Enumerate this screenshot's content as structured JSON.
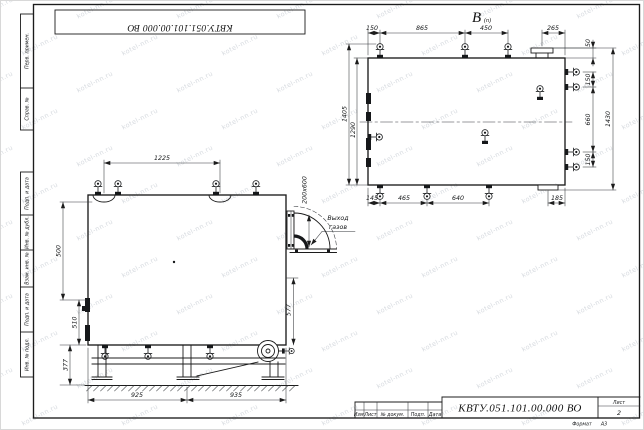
{
  "stamp": {
    "doc_number_rotated": "КВТУ.051.101.00.000  ВО"
  },
  "view_label": {
    "main": "В",
    "sub": "(п)"
  },
  "front_view": {
    "dim_top": "1225",
    "dim_left_upper": "500",
    "dim_left_mid": "510",
    "dim_left_lower": "377",
    "dim_right": "577",
    "dim_duct": "200x600",
    "dim_bottom_left": "925",
    "dim_bottom_right": "935",
    "label_gas_outlet_line1": "Выход",
    "label_gas_outlet_line2": "газов"
  },
  "plan_view": {
    "dim_top_1": "150",
    "dim_top_2": "865",
    "dim_top_3": "450",
    "dim_top_4": "265",
    "dim_flange_offset": "50",
    "dim_right_1": "150",
    "dim_right_2": "660",
    "dim_right_3": "150",
    "dim_right_overall": "1430",
    "dim_left_outer": "1405",
    "dim_left_inner": "1290",
    "dim_bottom_1": "145",
    "dim_bottom_2": "465",
    "dim_bottom_3": "640",
    "dim_bottom_4": "185"
  },
  "margin_labels": {
    "cell_1": "Перв. примен.",
    "cell_2": "Справ. №",
    "cell_3": "Подп. и дата",
    "cell_4": "Инв. № дубл.",
    "cell_5": "Взам. инв. №",
    "cell_6": "Подп. и дата",
    "cell_7": "Инв. № подл."
  },
  "title_block": {
    "col_izm": "Изм.",
    "col_list": "Лист",
    "col_doc": "№ докум.",
    "col_podp": "Подп.",
    "col_data": "Дата",
    "doc_number": "КВТУ.051.101.00.000  ВО",
    "sheet_label": "Лист",
    "sheet_value": "2",
    "format_label": "Формат",
    "format_value": "А3"
  },
  "watermark": {
    "text": "kotel-nn.ru"
  }
}
